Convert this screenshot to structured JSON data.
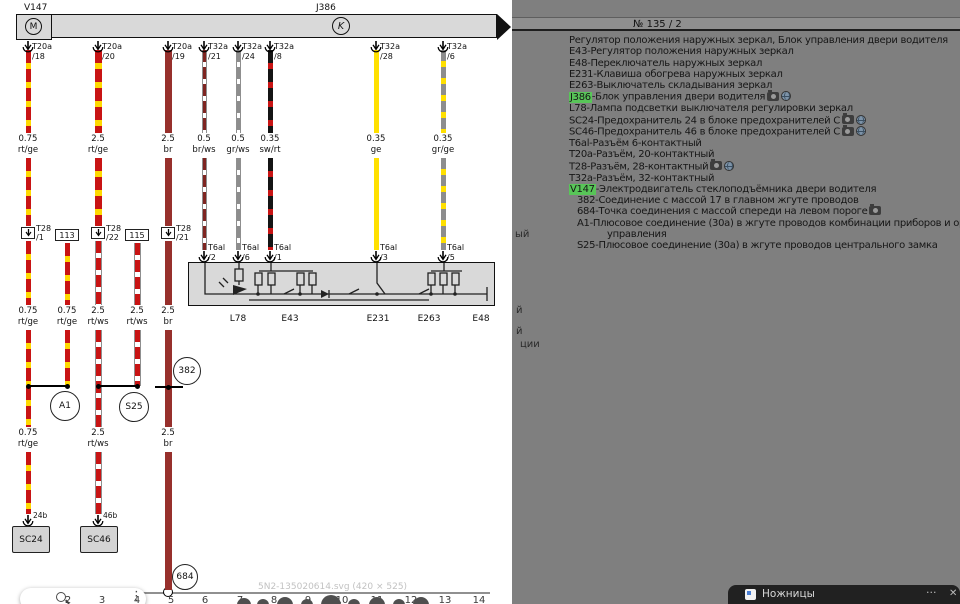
{
  "header": {
    "page_number": "№  135 / 2"
  },
  "diagram": {
    "v147_label": "V147",
    "j386_label": "J386",
    "motor_letter": "M",
    "clamp_letter": "K",
    "watermark": "5N2-135020614.svg (420 × 525)",
    "colors": {
      "wire_red": "#c81414",
      "wire_yellow": "#ffd900",
      "wire_brown": "#97302c",
      "wire_gray": "#8d8d8d",
      "highlight_green": "#58c558"
    },
    "top_connectors": [
      {
        "x": 28,
        "name": "T20a",
        "pin": "/18"
      },
      {
        "x": 98,
        "name": "T20a",
        "pin": "/20"
      },
      {
        "x": 168,
        "name": "T20a",
        "pin": "/19"
      },
      {
        "x": 204,
        "name": "T32a",
        "pin": "/21"
      },
      {
        "x": 238,
        "name": "T32a",
        "pin": "/24"
      },
      {
        "x": 270,
        "name": "T32a",
        "pin": "/8"
      },
      {
        "x": 376,
        "name": "T32a",
        "pin": "/28"
      },
      {
        "x": 443,
        "name": "T32a",
        "pin": "/6"
      }
    ],
    "segments": [
      {
        "x": 28,
        "w": 5,
        "pat": "rt-ge",
        "y1": 50,
        "y2": 133
      },
      {
        "x": 28,
        "w": 5,
        "pat": "rt-ge",
        "y1": 158,
        "y2": 226
      },
      {
        "x": 28,
        "w": 5,
        "pat": "rt-ge",
        "y1": 241,
        "y2": 305
      },
      {
        "x": 28,
        "w": 5,
        "pat": "rt-ge",
        "y1": 330,
        "y2": 427
      },
      {
        "x": 28,
        "w": 5,
        "pat": "rt-ge",
        "y1": 452,
        "y2": 514
      },
      {
        "x": 67,
        "w": 5,
        "pat": "rt-ge",
        "y1": 243,
        "y2": 305
      },
      {
        "x": 67,
        "w": 5,
        "pat": "rt-ge",
        "y1": 330,
        "y2": 386
      },
      {
        "x": 98,
        "w": 7,
        "pat": "rt-ge",
        "y1": 50,
        "y2": 133
      },
      {
        "x": 98,
        "w": 7,
        "pat": "rt-ge",
        "y1": 158,
        "y2": 226
      },
      {
        "x": 98,
        "w": 7,
        "pat": "rt-ws",
        "y1": 241,
        "y2": 305
      },
      {
        "x": 98,
        "w": 7,
        "pat": "rt-ws",
        "y1": 330,
        "y2": 427
      },
      {
        "x": 98,
        "w": 7,
        "pat": "rt-ws",
        "y1": 452,
        "y2": 514
      },
      {
        "x": 137,
        "w": 7,
        "pat": "rt-ws",
        "y1": 243,
        "y2": 305
      },
      {
        "x": 137,
        "w": 7,
        "pat": "rt-ws",
        "y1": 330,
        "y2": 386
      },
      {
        "x": 168,
        "w": 7,
        "pat": "br",
        "y1": 50,
        "y2": 133
      },
      {
        "x": 168,
        "w": 7,
        "pat": "br",
        "y1": 158,
        "y2": 226
      },
      {
        "x": 168,
        "w": 7,
        "pat": "br",
        "y1": 241,
        "y2": 305
      },
      {
        "x": 168,
        "w": 7,
        "pat": "br",
        "y1": 330,
        "y2": 427
      },
      {
        "x": 168,
        "w": 7,
        "pat": "br",
        "y1": 452,
        "y2": 590
      },
      {
        "x": 204,
        "w": 5,
        "pat": "br-ws",
        "y1": 50,
        "y2": 133
      },
      {
        "x": 204,
        "w": 5,
        "pat": "br-ws",
        "y1": 158,
        "y2": 250
      },
      {
        "x": 238,
        "w": 5,
        "pat": "gr-ws",
        "y1": 50,
        "y2": 133
      },
      {
        "x": 238,
        "w": 5,
        "pat": "gr-ws",
        "y1": 158,
        "y2": 250
      },
      {
        "x": 270,
        "w": 5,
        "pat": "sw-rt",
        "y1": 50,
        "y2": 133
      },
      {
        "x": 270,
        "w": 5,
        "pat": "sw-rt",
        "y1": 158,
        "y2": 250
      },
      {
        "x": 376,
        "w": 5,
        "pat": "ge",
        "y1": 50,
        "y2": 133
      },
      {
        "x": 376,
        "w": 5,
        "pat": "ge",
        "y1": 158,
        "y2": 250
      },
      {
        "x": 443,
        "w": 5,
        "pat": "gr-ge",
        "y1": 50,
        "y2": 133
      },
      {
        "x": 443,
        "w": 5,
        "pat": "gr-ge",
        "y1": 158,
        "y2": 250
      }
    ],
    "label_rows": [
      {
        "y": 134,
        "items": [
          {
            "x": 28,
            "g": "0.75",
            "c": "rt/ge"
          },
          {
            "x": 98,
            "g": "2.5",
            "c": "rt/ge"
          },
          {
            "x": 168,
            "g": "2.5",
            "c": "br"
          },
          {
            "x": 204,
            "g": "0.5",
            "c": "br/ws"
          },
          {
            "x": 238,
            "g": "0.5",
            "c": "gr/ws"
          },
          {
            "x": 270,
            "g": "0.35",
            "c": "sw/rt"
          },
          {
            "x": 376,
            "g": "0.35",
            "c": "ge"
          },
          {
            "x": 443,
            "g": "0.35",
            "c": "gr/ge"
          }
        ]
      },
      {
        "y": 306,
        "items": [
          {
            "x": 28,
            "g": "0.75",
            "c": "rt/ge"
          },
          {
            "x": 67,
            "g": "0.75",
            "c": "rt/ge"
          },
          {
            "x": 98,
            "g": "2.5",
            "c": "rt/ws"
          },
          {
            "x": 137,
            "g": "2.5",
            "c": "rt/ws"
          },
          {
            "x": 168,
            "g": "2.5",
            "c": "br"
          }
        ]
      },
      {
        "y": 428,
        "items": [
          {
            "x": 28,
            "g": "0.75",
            "c": "rt/ge"
          },
          {
            "x": 98,
            "g": "2.5",
            "c": "rt/ws"
          },
          {
            "x": 168,
            "g": "2.5",
            "c": "br"
          }
        ]
      }
    ],
    "t28_pins": [
      {
        "x": 28,
        "name": "T28",
        "pin": "/1"
      },
      {
        "x": 98,
        "name": "T28",
        "pin": "/22"
      },
      {
        "x": 168,
        "name": "T28",
        "pin": "/21"
      }
    ],
    "junction_boxes": [
      {
        "x": 67,
        "label": "113"
      },
      {
        "x": 137,
        "label": "115"
      }
    ],
    "t6al_pins": [
      {
        "x": 204,
        "name": "T6al",
        "pin": "/2"
      },
      {
        "x": 238,
        "name": "T6al",
        "pin": "/6"
      },
      {
        "x": 270,
        "name": "T6al",
        "pin": "/1"
      },
      {
        "x": 376,
        "name": "T6al",
        "pin": "/3"
      },
      {
        "x": 443,
        "name": "T6al",
        "pin": "/5"
      }
    ],
    "component_labels": [
      {
        "x": 238,
        "text": "L78"
      },
      {
        "x": 290,
        "text": "E43"
      },
      {
        "x": 378,
        "text": "E231"
      },
      {
        "x": 429,
        "text": "E263"
      },
      {
        "x": 481,
        "text": "E48"
      }
    ],
    "junction_lines": [
      {
        "x1": 28,
        "x2": 67,
        "y": 385
      },
      {
        "x1": 98,
        "x2": 137,
        "y": 385
      },
      {
        "x1": 155,
        "x2": 183,
        "y": 386
      }
    ],
    "junction_dots": [
      {
        "x": 28,
        "y": 386
      },
      {
        "x": 67,
        "y": 386
      },
      {
        "x": 98,
        "y": 386
      },
      {
        "x": 137,
        "y": 386
      },
      {
        "x": 168,
        "y": 387
      }
    ],
    "junction_circles": [
      {
        "x": 65,
        "y": 406,
        "r": 15,
        "label": "A1"
      },
      {
        "x": 134,
        "y": 407,
        "r": 15,
        "label": "S25"
      },
      {
        "x": 187,
        "y": 371,
        "r": 14,
        "label": "382"
      },
      {
        "x": 185,
        "y": 577,
        "r": 13,
        "label": "684"
      }
    ],
    "fuses": [
      {
        "x": 28,
        "bx": 12,
        "label": "SC24",
        "pin": "24b"
      },
      {
        "x": 98,
        "bx": 80,
        "label": "SC46",
        "pin": "46b"
      }
    ],
    "ruler": [
      "2",
      "3",
      "4",
      "5",
      "6",
      "7",
      "8",
      "9",
      "10",
      "11",
      "12",
      "13",
      "14"
    ],
    "ruler_xs": [
      68,
      102,
      137,
      171,
      205,
      240,
      274,
      308,
      342,
      377,
      411,
      445,
      479
    ],
    "pag_dots": [
      {
        "x": 244,
        "r": 7
      },
      {
        "x": 263,
        "r": 6
      },
      {
        "x": 285,
        "r": 8
      },
      {
        "x": 307,
        "r": 6
      },
      {
        "x": 331,
        "r": 10
      },
      {
        "x": 354,
        "r": 6
      },
      {
        "x": 377,
        "r": 8
      },
      {
        "x": 399,
        "r": 6
      },
      {
        "x": 421,
        "r": 8
      }
    ]
  },
  "legend": {
    "lines": [
      {
        "text": "Регулятор положения наружных зеркал, Блок управления двери водителя"
      },
      {
        "text": "Е43-Регулятор положения наружных зеркал"
      },
      {
        "text": "Е48-Переключатель наружных зеркал"
      },
      {
        "text": "Е231-Клавиша обогрева наружных зеркал"
      },
      {
        "text": "Е263-Выключатель складывания зеркал"
      },
      {
        "hl": "J386",
        "text": "-Блок управления двери водителя",
        "icons": [
          "camera",
          "globe"
        ]
      },
      {
        "text": "L78-Лампа подсветки выключателя регулировки зеркал"
      },
      {
        "text": "SC24-Предохранитель 24 в блоке предохранителей C",
        "icons": [
          "camera",
          "globe"
        ]
      },
      {
        "text": "SC46-Предохранитель 46 в блоке предохранителей C",
        "icons": [
          "camera",
          "globe"
        ]
      },
      {
        "text": "T6al-Разъём 6-контактный"
      },
      {
        "text": "T20a-Разъём, 20-контактный"
      },
      {
        "text": "T28-Разъём, 28-контактный",
        "icons": [
          "camera",
          "globe"
        ]
      },
      {
        "text": "T32a-Разъём, 32-контактный"
      },
      {
        "hl": "V147",
        "text": "-Электродвигатель стеклоподъёмника двери водителя"
      },
      {
        "text": "382-Соединение с массой 17 в главном жгуте проводов",
        "indent": 8
      },
      {
        "text": "684-Точка соединения с массой спереди на левом пороге",
        "indent": 8,
        "icons": [
          "camera"
        ]
      },
      {
        "text": "А1-Плюсовое соединение (30а) в жгуте проводов комбинации приборов и органов",
        "indent": 8
      },
      {
        "text": "управления",
        "indent": 38
      },
      {
        "text": "S25-Плюсовое соединение (30а) в жгуте проводов центрального замка",
        "indent": 8
      }
    ],
    "fragments": [
      {
        "x": 515,
        "y": 229,
        "t": "ый"
      },
      {
        "x": 516,
        "y": 305,
        "t": "й"
      },
      {
        "x": 516,
        "y": 326,
        "t": "й"
      },
      {
        "x": 520,
        "y": 339,
        "t": "ции"
      }
    ]
  },
  "snip": {
    "title": "Ножницы",
    "more": "···",
    "close": "✕"
  }
}
